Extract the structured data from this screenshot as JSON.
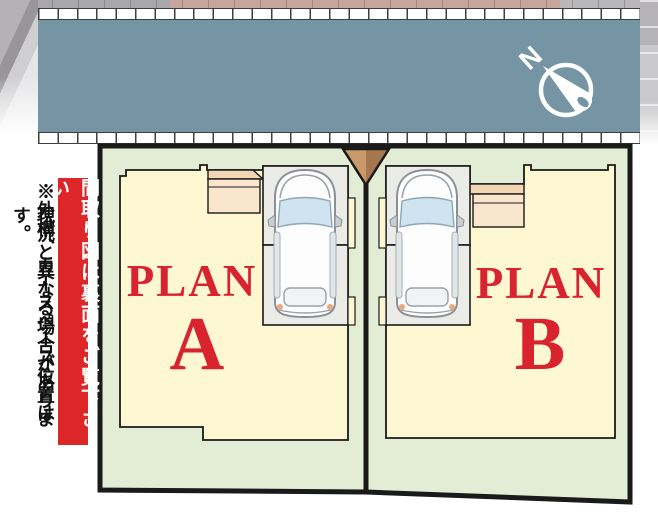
{
  "palette": {
    "road": "#7595a4",
    "site_green": "#e3edd6",
    "footprint_yellow": "#fdf8d2",
    "parking_gray": "#ebebe8",
    "porch_light": "#f9e6cc",
    "porch_dark": "#f3d6b4",
    "driveway_left": "#c9996a",
    "driveway_right": "#a5774e",
    "accent_red": "#d9232e",
    "outline_black": "#1a1a1a",
    "compass_white": "#ffffff"
  },
  "compass": {
    "label": "N"
  },
  "side_notes": {
    "banner": "間取り図は裏面をご覧下さい",
    "disclaimer_col1": "※外構、カースペース位置は",
    "disclaimer_col2": "現況と異なる場合があります。"
  },
  "plots": [
    {
      "word": "PLAN",
      "letter": "A"
    },
    {
      "word": "PLAN",
      "letter": "B"
    }
  ]
}
